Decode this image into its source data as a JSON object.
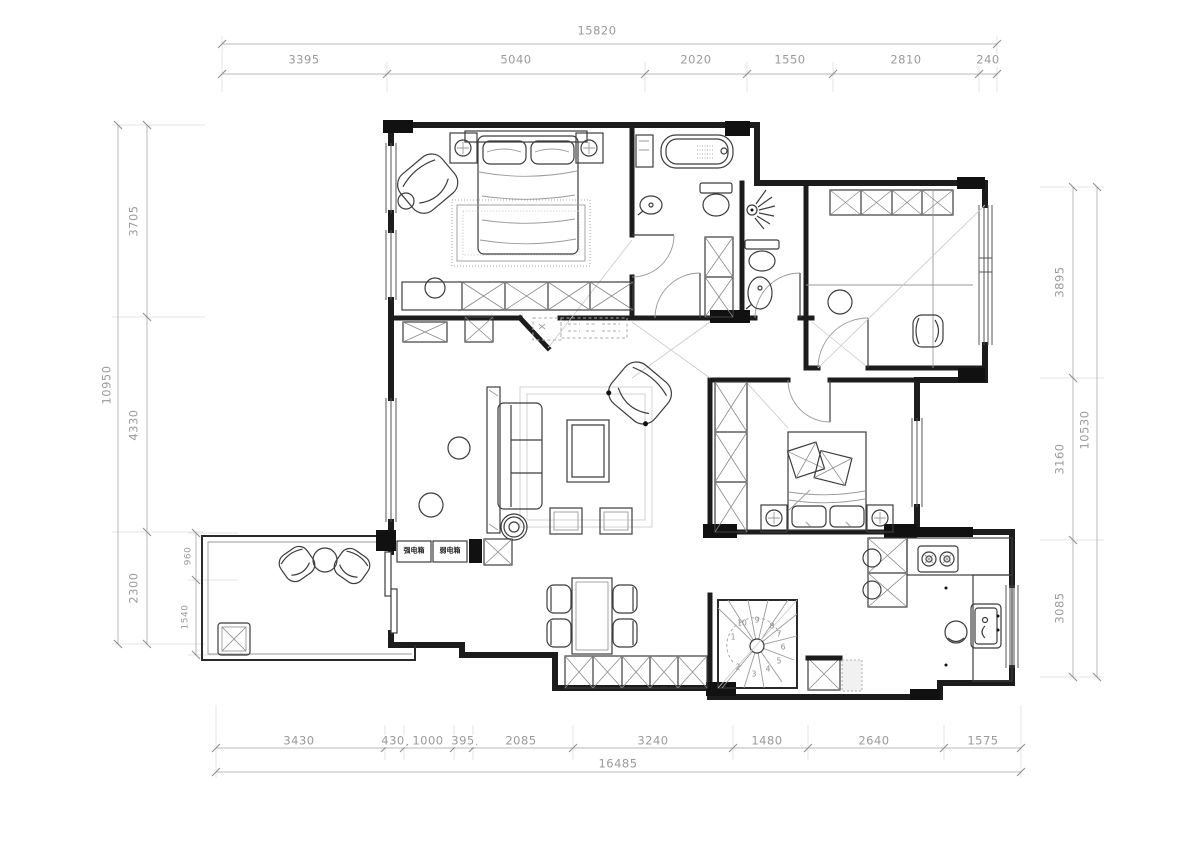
{
  "title": "apartment-floor-plan",
  "dims": {
    "top": {
      "total": "15820",
      "segments": [
        "3395",
        "5040",
        "2020",
        "1550",
        "2810",
        "240"
      ]
    },
    "bottom": {
      "total": "16485",
      "segments": [
        "3430",
        "430",
        "1000",
        "395",
        "2085",
        "3240",
        "1480",
        "2640",
        "1575"
      ]
    },
    "left": {
      "total": "10950",
      "segments": [
        "3705",
        "4330",
        "2300"
      ],
      "inner": [
        "960",
        "1540"
      ]
    },
    "right": {
      "total": "10530",
      "segments": [
        "3895",
        "3160",
        "3085"
      ]
    }
  },
  "labels": {
    "strong_box": "强电箱",
    "weak_box": "弱电箱"
  },
  "stairs": {
    "steps": [
      "1",
      "2",
      "3",
      "4",
      "5",
      "6",
      "7",
      "8",
      "9",
      "10"
    ]
  },
  "colors": {
    "wall": "#1c1c1c",
    "dim_text": "#9a9a9a",
    "line": "#3c3c3c",
    "background": "#ffffff"
  }
}
